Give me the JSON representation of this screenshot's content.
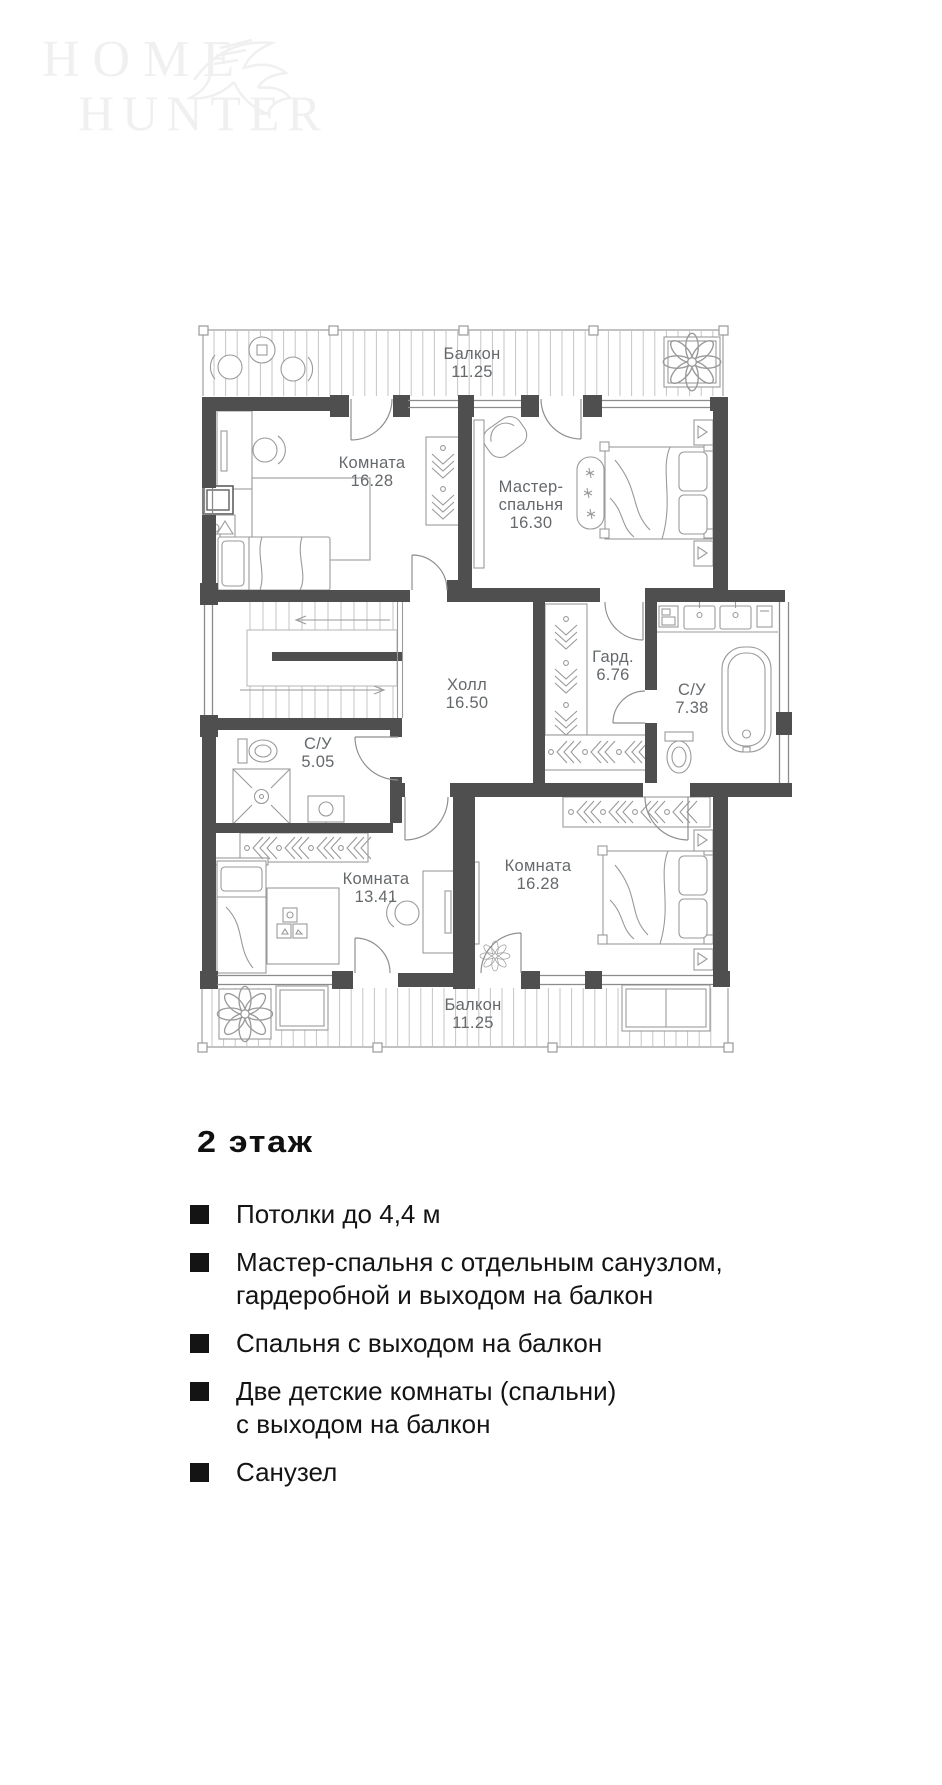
{
  "logo": {
    "line1": "Home",
    "line2": "Hunter"
  },
  "plan": {
    "rooms": [
      {
        "id": "balcony-top",
        "name": "Балкон",
        "area": "11.25"
      },
      {
        "id": "room-top-left",
        "name": "Комната",
        "area": "16.28"
      },
      {
        "id": "master-bedroom",
        "name": "Мастер-спальня",
        "area": "16.30"
      },
      {
        "id": "hall",
        "name": "Холл",
        "area": "16.50"
      },
      {
        "id": "wardrobe",
        "name": "Гард.",
        "area": "6.76"
      },
      {
        "id": "bathroom-master",
        "name": "С/У",
        "area": "7.38"
      },
      {
        "id": "bathroom-small",
        "name": "С/У",
        "area": "5.05"
      },
      {
        "id": "room-bottom-left",
        "name": "Комната",
        "area": "13.41"
      },
      {
        "id": "room-bottom-right",
        "name": "Комната",
        "area": "16.28"
      },
      {
        "id": "balcony-bottom",
        "name": "Балкон",
        "area": "11.25"
      }
    ]
  },
  "details": {
    "title": "2 этаж",
    "bullets": [
      {
        "lines": [
          "Потолки до 4,4 м"
        ]
      },
      {
        "lines": [
          "Мастер-спальня с отдельным санузлом,",
          "гардеробной и выходом на балкон"
        ]
      },
      {
        "lines": [
          "Спальня с выходом на балкон"
        ]
      },
      {
        "lines": [
          "Две детские комнаты (спальни)",
          "с выходом на балкон"
        ]
      },
      {
        "lines": [
          "Санузел"
        ]
      }
    ]
  },
  "colors": {
    "wall": "#4f4f4f",
    "line": "#9a9a9a",
    "label": "#65696c",
    "text": "#141414",
    "logo": "#f0f0f0"
  }
}
